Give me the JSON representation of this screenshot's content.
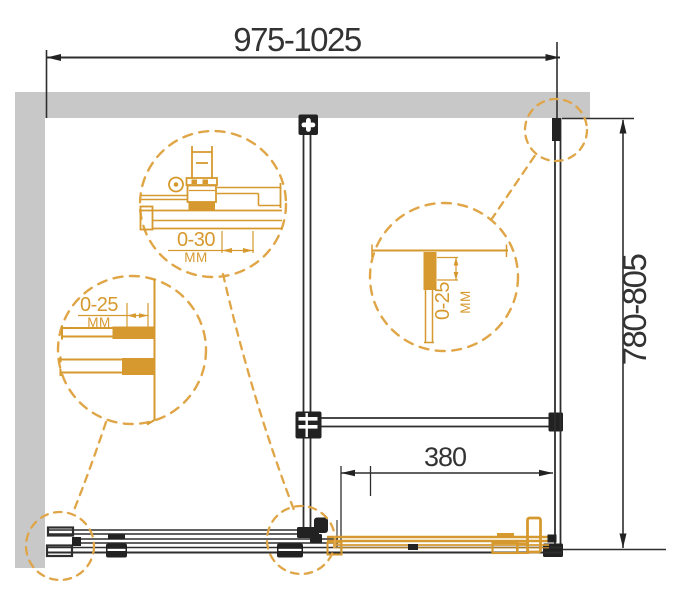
{
  "drawing": {
    "type": "shower-enclosure-installation-diagram",
    "dimensions": {
      "width_label": "975-1025",
      "depth_label": "780-805",
      "opening_label": "380"
    },
    "details": {
      "roller": {
        "range": "0-30",
        "unit": "MM"
      },
      "wall_profile": {
        "range": "0-25",
        "unit": "MM"
      },
      "vertical_profile": {
        "range": "0-25",
        "unit": "MM"
      }
    },
    "colors": {
      "accent_orange": "#d6992f",
      "dash_orange": "#dfa546",
      "line_black": "#2e2e2e",
      "wall_gray": "#c8c8c8"
    }
  }
}
